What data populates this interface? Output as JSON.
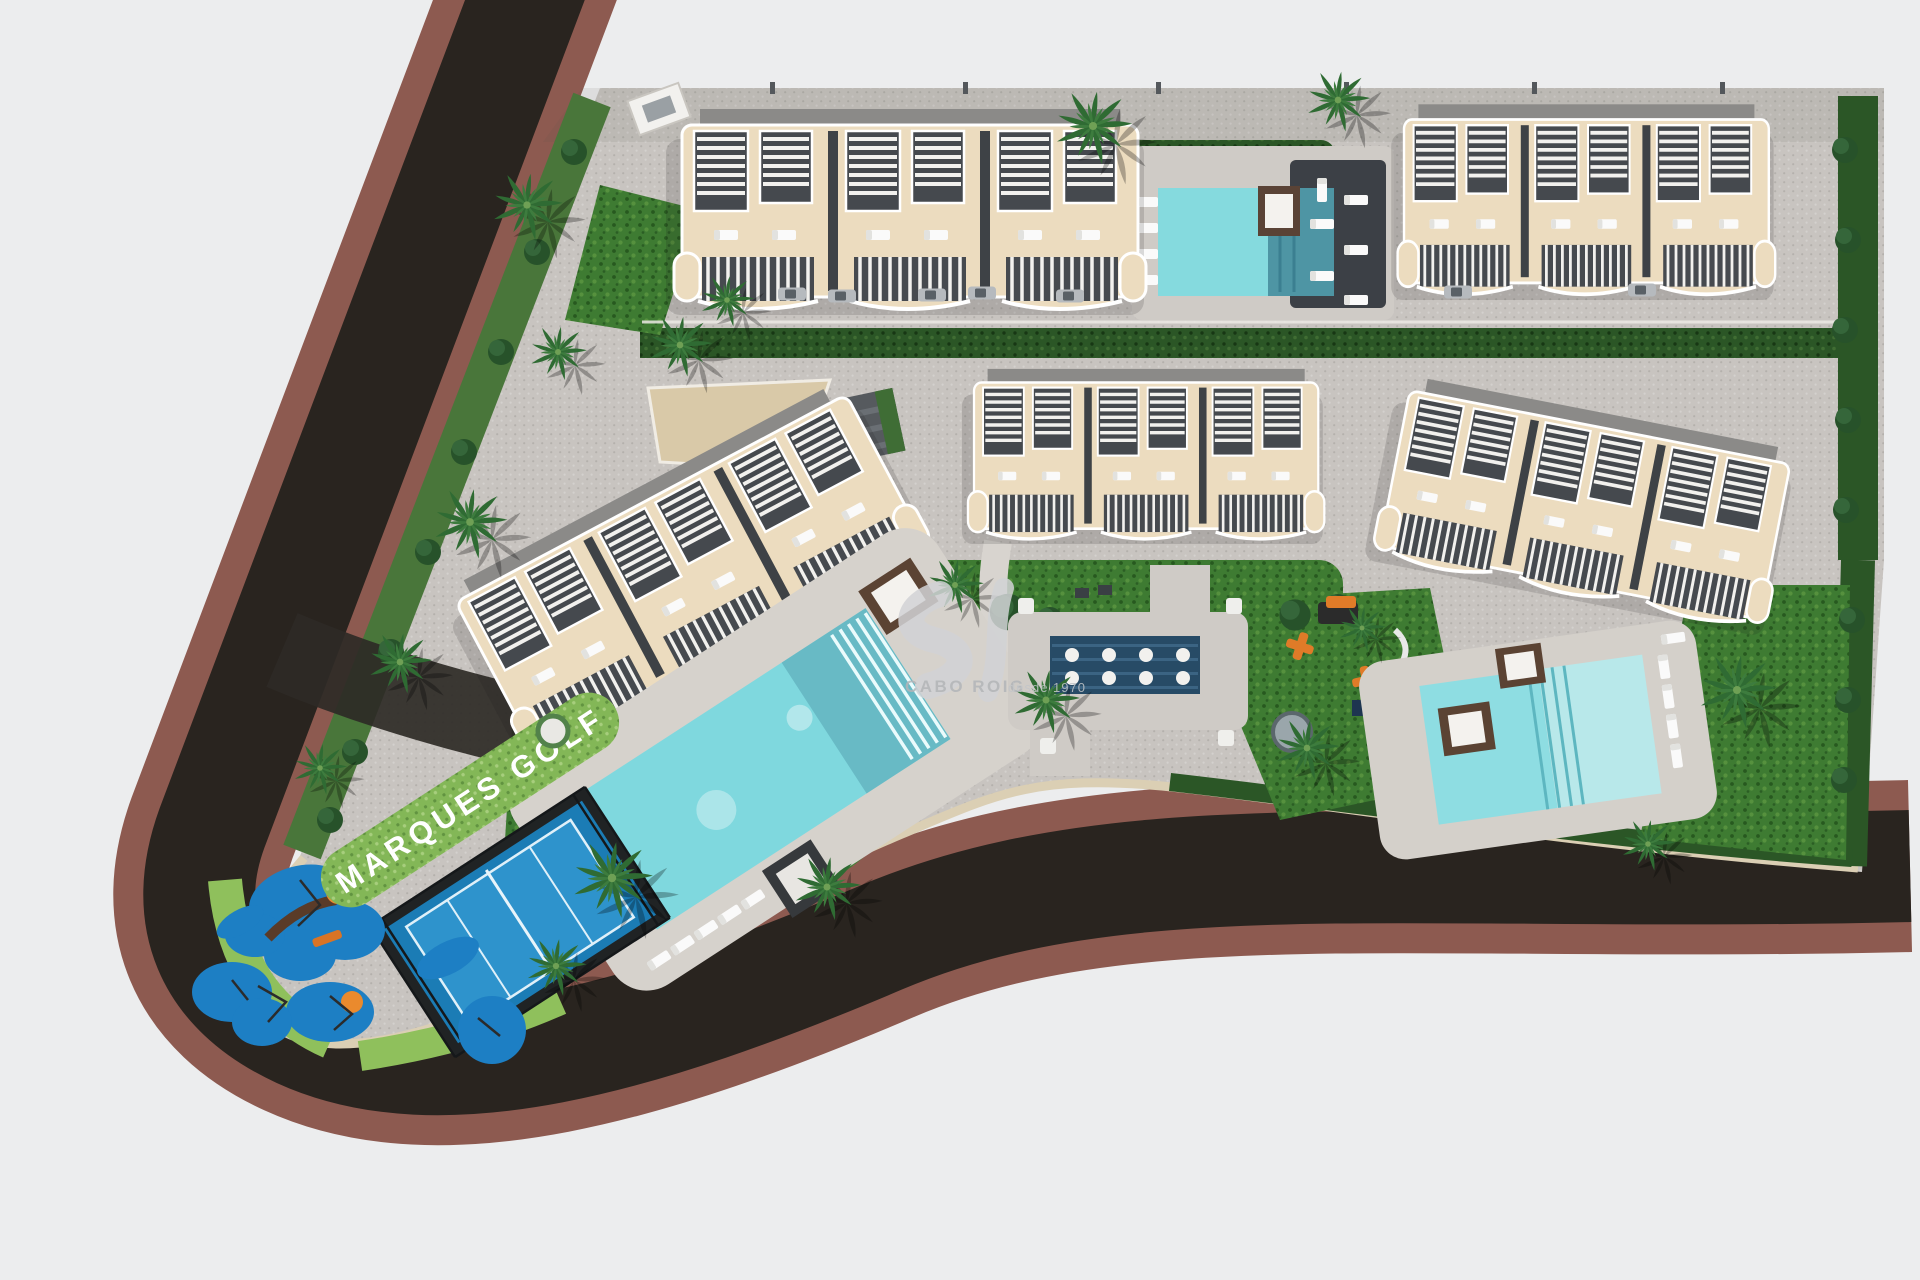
{
  "scene": {
    "type": "aerial-3d-site-plan-render",
    "development_sign": "MARQUES GOLF",
    "watermark": {
      "brand": "CABO ROIG",
      "tagline": "desde 1970",
      "mark": "script-monogram-logo"
    },
    "palette": {
      "background": "#ECEDEE",
      "pavement": "#C8C4C0",
      "road_asphalt": "#29241F",
      "road_sidewalk": "#8D5A50",
      "curb": "#DBCFB4",
      "lawn": "#3E7B32",
      "hedge": "#2B5626",
      "sign_hedge": "#83B757",
      "building_terrace": "#ECDCBF",
      "building_roof": "#8B8A88",
      "pergola_slats": "#45494E",
      "pool_water": "#7FD8DE",
      "spa_water": "#274B66",
      "sport_court": "#1B7CB5",
      "playground_surface": "#1D7FC4",
      "play_accent": "#E8872C",
      "palm_foliage": "#2F6B33",
      "daybed_wood": "#5B4333"
    },
    "features": {
      "apartment_blocks": 5,
      "swimming_pools": 3,
      "spa_pool_jets": 8,
      "padel_court": 1,
      "playground": 1,
      "outdoor_gym": 1
    }
  }
}
